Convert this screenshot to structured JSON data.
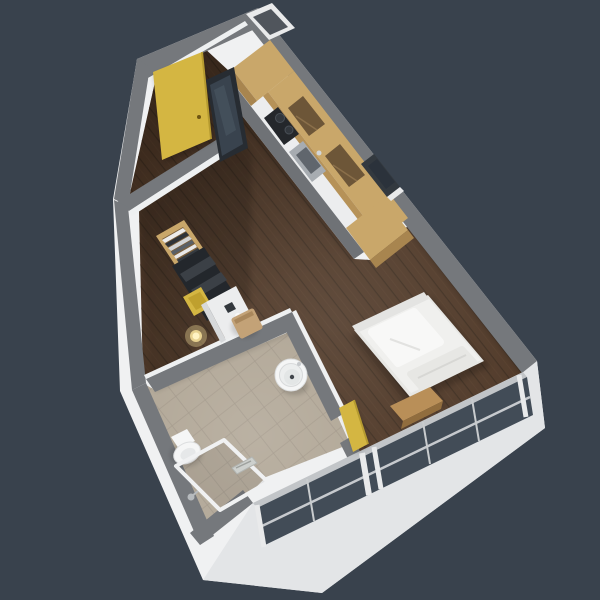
{
  "app": {
    "title": "Studio Apartment 3D Floor Plan",
    "description": "Axonometric 3D render of a small studio apartment floor plan viewed from above, on a dark slate background"
  },
  "palette": {
    "bg": "#39424d",
    "wallTop": "#75787c",
    "wallTopLight": "#83868a",
    "wallFace": "#f0f1f2",
    "wallFaceShade": "#e3e5e7",
    "wallInner": "#eef0f1",
    "floorWood": "#4f3827",
    "floorWoodLine": "#3e2d1f",
    "floorWoodStreak": "#5d4430",
    "tile": "#b3a999",
    "tileLine": "#a2988a",
    "oak": "#c9a76a",
    "oakDark": "#a8854f",
    "oakFace": "#b69258",
    "recess": "#6d5638",
    "counter": "#ecedee",
    "cabinetBase": "#6f7276",
    "cooktop": "#24272b",
    "burner": "#32373d",
    "steel": "#a7acb1",
    "steelDark": "#60666d",
    "yellow": "#d4b642",
    "yellowDark": "#bfa02e",
    "yellowEdge": "#b59a30",
    "glass": "#424c57",
    "glassDark": "#2b323b",
    "frameDark": "#33393f",
    "white": "#f0f0ee",
    "whiteBright": "#f8f8f7",
    "cream": "#e7e7e4",
    "benchWood": "#b98f58",
    "benchWoodDark": "#916d3e",
    "chairTan": "#c3a277",
    "chairTanDark": "#a9875c",
    "shelfDark": "#23272c",
    "shelfSlat": "#3b4046",
    "mirrorGlass": "#39434e",
    "lampGlow": "#ffe9a0",
    "fixtureWhite": "#f5f6f6",
    "fixtureStroke": "#dcdedf",
    "sillWhite": "#e9eaeb",
    "mullion": "#c9ccce",
    "railGray": "#c2c5c8",
    "shaftInner": "#50555c",
    "clothes0": "#ececec",
    "clothes1": "#2f343a",
    "clothes2": "#d3d5d6",
    "clothes3": "#596067",
    "clothes4": "#e8e8e8",
    "clothes5": "#343a40"
  },
  "rooms": [
    {
      "id": "entry-hall",
      "label": "Entry hall"
    },
    {
      "id": "kitchen",
      "label": "Kitchen"
    },
    {
      "id": "living-room",
      "label": "Living room"
    },
    {
      "id": "dressing-nook",
      "label": "Dressing nook"
    },
    {
      "id": "bathroom",
      "label": "Bathroom"
    }
  ],
  "objects": {
    "entry": [
      "yellow entry door",
      "leaning mirror panel",
      "duct shaft"
    ],
    "kitchen": [
      "tall oak cabinet",
      "oak upper cabinets with open shelves",
      "white countertop",
      "two-burner cooktop",
      "stainless steel sink",
      "grey base cabinets"
    ],
    "living": [
      "double bed with pillow and folded duvet",
      "low wooden bench",
      "small framed wall window",
      "floor-to-ceiling glazing"
    ],
    "nook": [
      "open oak wardrobe with folded clothes",
      "dark shelving unit",
      "yellow lounge chair",
      "glowing floor lamp",
      "white desk",
      "tan desk chair"
    ],
    "bathroom": [
      "toilet",
      "walk-in shower with glass screen and linear drain",
      "round washbasin",
      "shower mixer",
      "yellow bathroom door"
    ]
  }
}
